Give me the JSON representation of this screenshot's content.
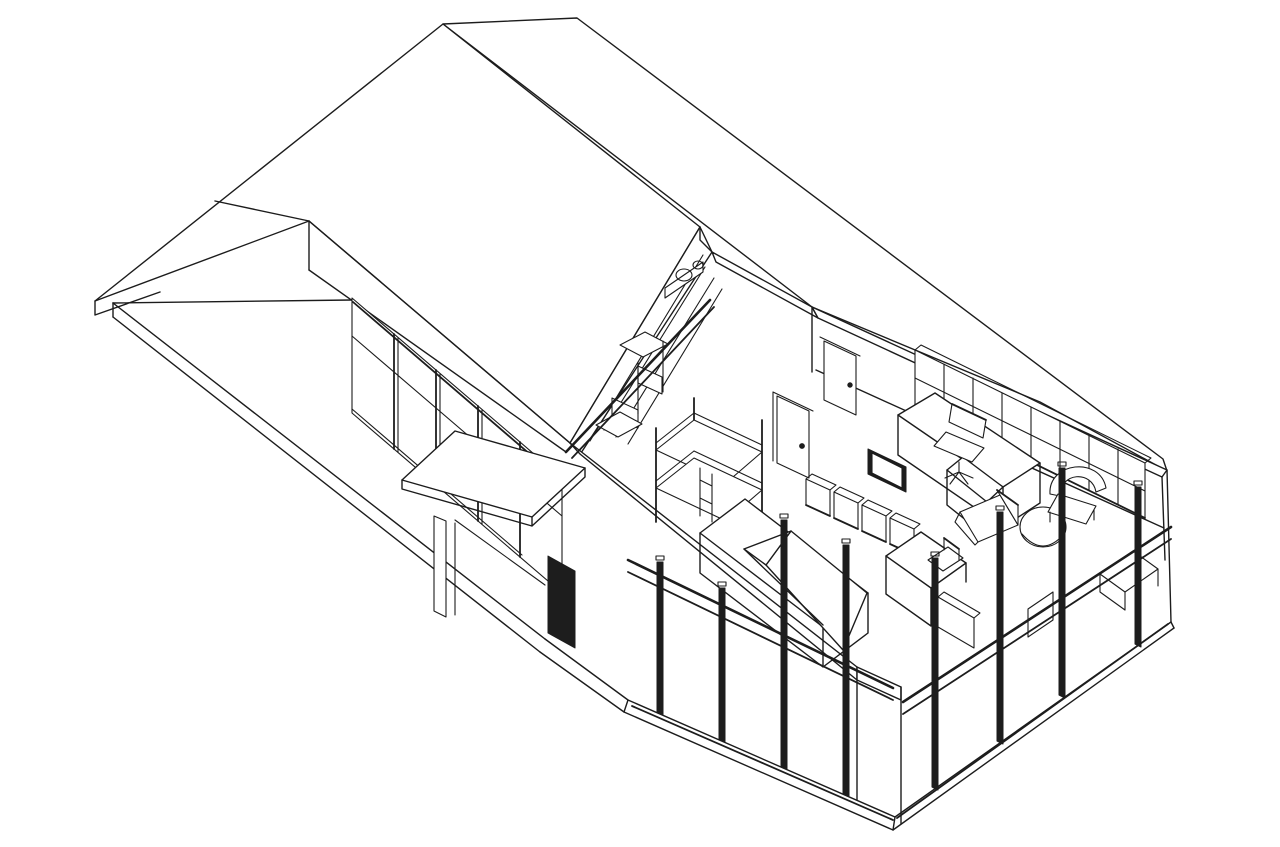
{
  "figure": {
    "title": "Sectional axonometric cutaway drawing of a single-storey house with loft",
    "style": "black line-art on white, CAD isometric",
    "background_color": "#ffffff",
    "line_color": "#1c1c1c",
    "accent_dark_color": "#1d1d1d",
    "canvas": {
      "width": 1280,
      "height": 847
    }
  },
  "components": {
    "site": [
      "ground-slab-terrace",
      "slab-fascia-edges"
    ],
    "left-wing": [
      "hip-roof",
      "roof-fascia",
      "window-band-with-mullions",
      "entry-porch-canopy",
      "porch-column",
      "entry-door"
    ],
    "section-cut": [
      "roof-cut-band",
      "attic-gable-face",
      "floor-cut-band",
      "front-wall-cut-band",
      "wall-stub"
    ],
    "attic-loft": [
      "sloped-shelving",
      "storage-boxes",
      "kitchenette-counter",
      "sink-basins",
      "handrail"
    ],
    "bunk-room": [
      "bunk-bed-frame",
      "interior-door-a",
      "interior-door-b"
    ],
    "main-room": [
      "back-wall-top-band",
      "long-cubby-shelving",
      "l-shaped-desk",
      "office-chair",
      "tv-panel",
      "cube-storage-row",
      "loveseat",
      "round-pouf-table",
      "armchair",
      "daybed-platform",
      "wedge-backrest",
      "writing-desk",
      "side-chair",
      "nightstand",
      "window-bench",
      "low-cabinet"
    ],
    "glazing": [
      "front-glass-wall",
      "right-glass-wall",
      "dark-mullion-posts",
      "head-rails",
      "sill-rails"
    ]
  }
}
